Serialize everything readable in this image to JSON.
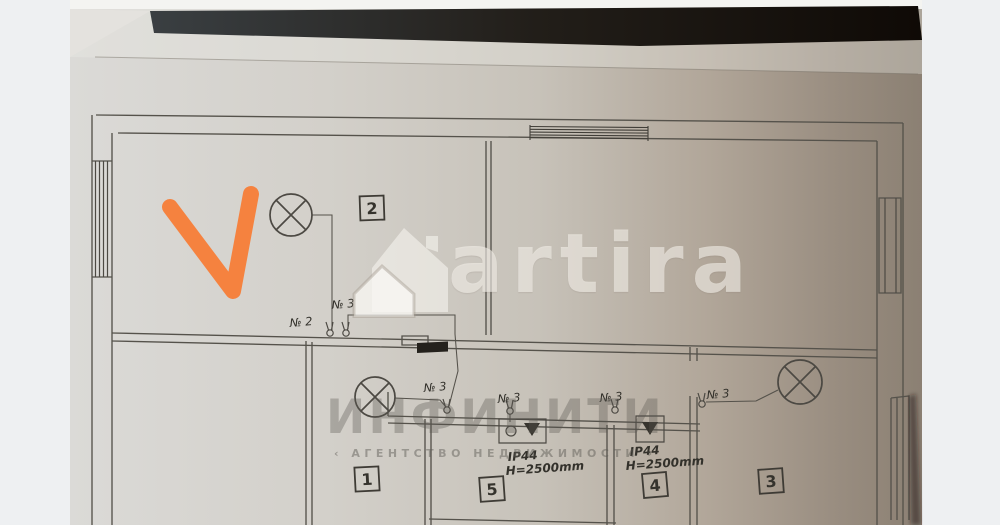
{
  "watermarks": {
    "artira": {
      "text": "artira"
    },
    "agency": {
      "title": "ИНФИНИТИ",
      "subtitle": "‹ АГЕНТСТВО НЕДВИЖИМОСТИ ›"
    }
  },
  "plan": {
    "rooms": [
      {
        "number": "2"
      },
      {
        "number": "1"
      },
      {
        "number": "5"
      },
      {
        "number": "4"
      },
      {
        "number": "3"
      }
    ],
    "labels": {
      "switch_no2": "№ 2",
      "switch_no3": "№ 3",
      "ip_rating": "IP44",
      "mount_height": "H=2500mm"
    },
    "icons": {
      "ceiling_light": "circle-with-x",
      "wall_switch": "circle-with-prongs",
      "checkmark": "orange-v",
      "house_logo": "double-house"
    },
    "colors": {
      "checkmark": "#f5823f",
      "paper": "#d6d3cd",
      "paper_shadow": "#8d8276",
      "line": "#55524b",
      "backdrop": "#eef0f2",
      "table": "#16120d"
    }
  }
}
